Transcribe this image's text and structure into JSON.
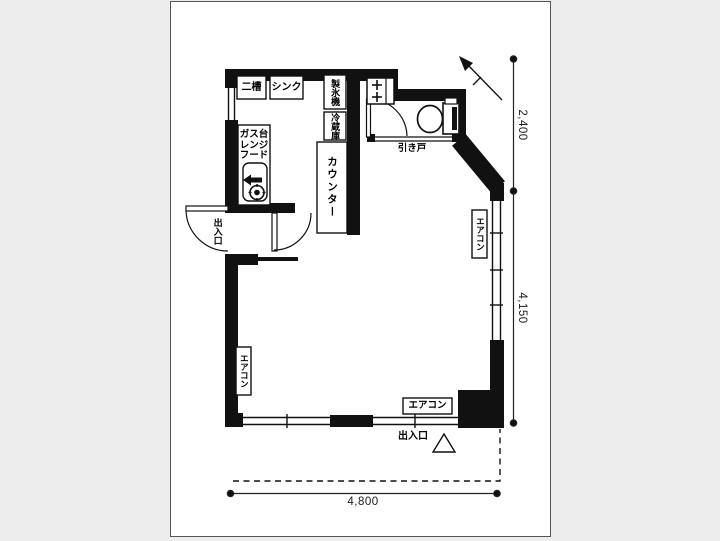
{
  "title": "間取り図",
  "labels": {
    "sink_double": "二槽",
    "sink": "シンク",
    "ice_maker": "製氷機",
    "refrigerator": "冷蔵庫",
    "counter": "カウンター",
    "sliding_door": "引き戸",
    "gas_line1": "ガス台",
    "gas_line2": "レンジ",
    "gas_line3": "フード",
    "entrance_left": "出入口",
    "entrance_bottom": "出入口",
    "aircon_left": "エアコン",
    "aircon_right": "エアコン",
    "aircon_bottom": "エアコン"
  },
  "dimensions": {
    "upper_right_mm": "2,400",
    "right_mm": "4,150",
    "bottom_mm": "4,800"
  },
  "colors": {
    "background": "#ededed",
    "paper": "#ffffff",
    "wall": "#111111",
    "line": "#222222"
  }
}
